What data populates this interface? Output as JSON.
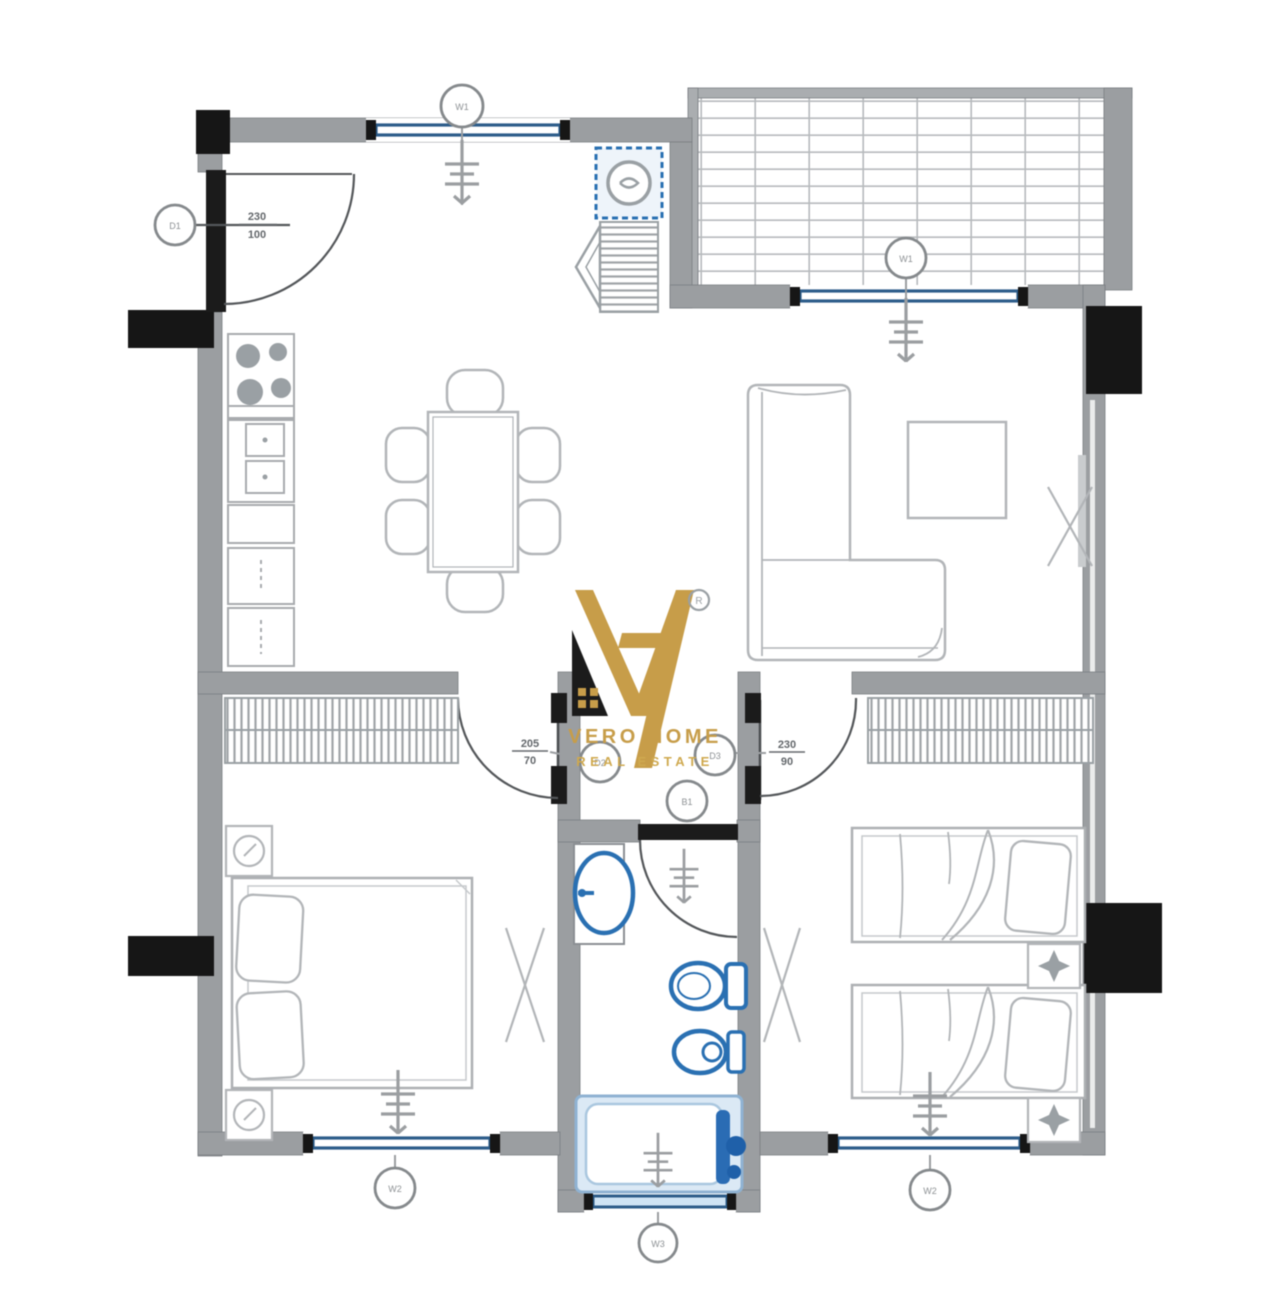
{
  "brand": {
    "line1": "VERO HOME",
    "line2": "REAL ESTATE",
    "registered": "R"
  },
  "labels": {
    "entrance": {
      "tag": "D1",
      "dim_top": "230",
      "dim_bottom": "100"
    },
    "window_kitchen": {
      "tag": "W1"
    },
    "window_terrace": {
      "tag": "W1"
    },
    "door_bedroom_left": {
      "tag": "D2",
      "dim_top": "205",
      "dim_bottom": "70"
    },
    "door_bedroom_right": {
      "tag": "D3",
      "dim_top": "230",
      "dim_bottom": "90"
    },
    "door_bathroom": {
      "tag": "B1"
    },
    "window_bedroom_left": {
      "tag": "W2"
    },
    "window_bathroom": {
      "tag": "W3"
    },
    "window_bedroom_right": {
      "tag": "W2"
    }
  },
  "colors": {
    "wall_gray": "#9b9ea1",
    "column_black": "#161616",
    "window_navy": "#2d5d8a",
    "fixture_blue": "#2a70b2",
    "tub_fill": "#dbe9f5",
    "furniture_gray": "#b2b5b8",
    "brand_gold": "#c79d49"
  }
}
